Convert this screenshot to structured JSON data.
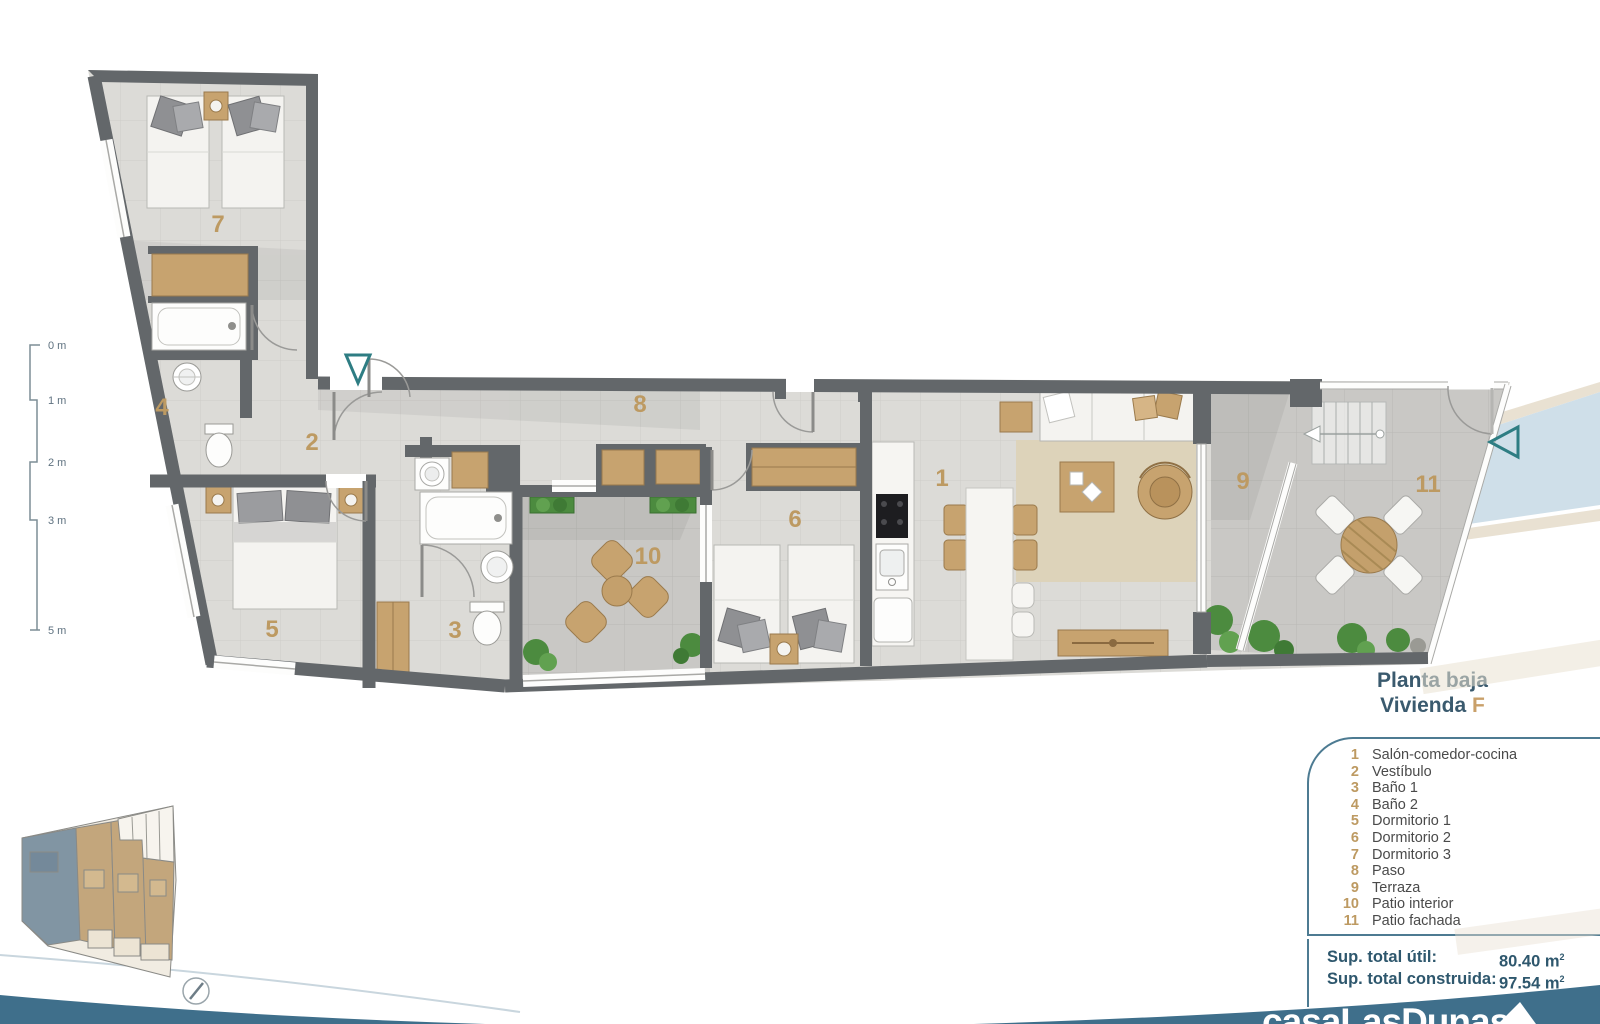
{
  "titles": {
    "floor": "Planta baja",
    "unit_prefix": "Vivienda",
    "unit_letter": "F"
  },
  "legend": {
    "items": [
      {
        "num": "1",
        "label": "Salón-comedor-cocina"
      },
      {
        "num": "2",
        "label": "Vestíbulo"
      },
      {
        "num": "3",
        "label": "Baño 1"
      },
      {
        "num": "4",
        "label": "Baño 2"
      },
      {
        "num": "5",
        "label": "Dormitorio 1"
      },
      {
        "num": "6",
        "label": "Dormitorio 2"
      },
      {
        "num": "7",
        "label": "Dormitorio 3"
      },
      {
        "num": "8",
        "label": "Paso"
      },
      {
        "num": "9",
        "label": "Terraza"
      },
      {
        "num": "10",
        "label": "Patio interior"
      },
      {
        "num": "11",
        "label": "Patio fachada"
      }
    ]
  },
  "totals": {
    "util_label": "Sup. total útil:",
    "util_value": "80.40 m",
    "built_label": "Sup. total construida:",
    "built_value": "97.54 m",
    "sup": "2"
  },
  "rooms": {
    "n1": "1",
    "n2": "2",
    "n3": "3",
    "n4": "4",
    "n5": "5",
    "n6": "6",
    "n7": "7",
    "n8": "8",
    "n9": "9",
    "n10": "10",
    "n11": "11"
  },
  "scale_labels": [
    "0 m",
    "1 m",
    "2 m",
    "3 m",
    "5 m"
  ],
  "logo_text": "casaLasDunas",
  "colors": {
    "wall": "#63676a",
    "tan": "#c7a36f",
    "number": "#bd9a62",
    "teal_band": "#3f6f8b",
    "title": "#3a5a6e",
    "accent_letter": "#c9a06a",
    "blue_band": "#cfdfe9",
    "green": "#4c8b3f"
  }
}
